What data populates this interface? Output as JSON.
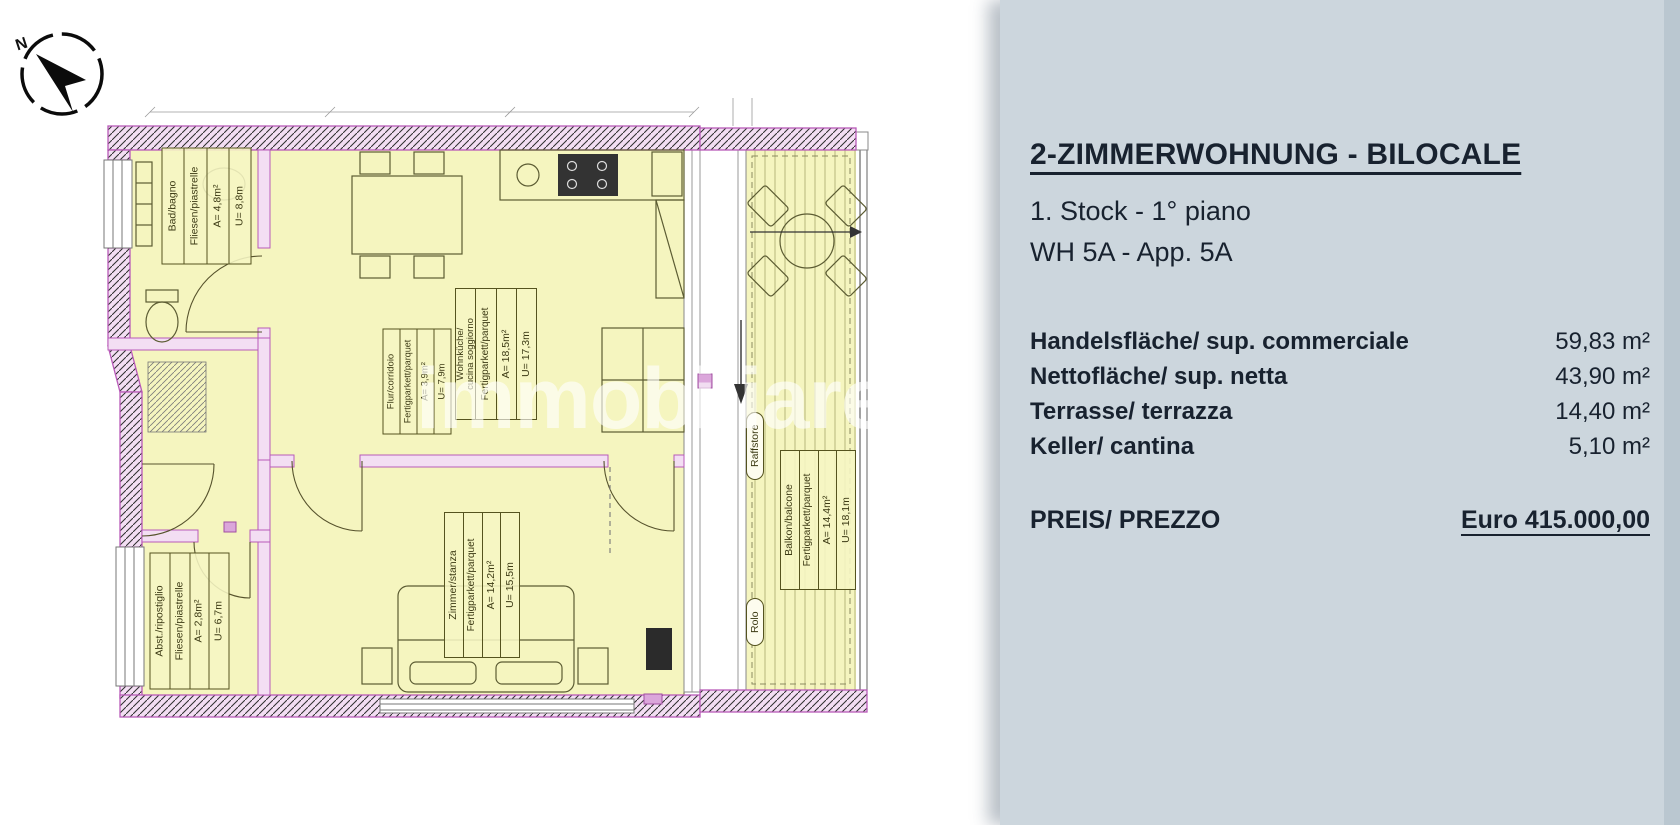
{
  "panel": {
    "title": "2-ZIMMERWOHNUNG - BILOCALE",
    "floor_line": "1. Stock - 1° piano",
    "unit_line": "WH 5A - App. 5A",
    "area_rows": [
      {
        "label": "Handelsfläche/ sup. commerciale",
        "value": "59,83 m²"
      },
      {
        "label": "Nettofläche/ sup. netta",
        "value": "43,90 m²"
      },
      {
        "label": "Terrasse/ terrazza",
        "value": "14,40 m²"
      },
      {
        "label": "Keller/ cantina",
        "value": "5,10 m²"
      }
    ],
    "price": {
      "label": "PREIS/ PREZZO",
      "value": "Euro 415.000,00"
    }
  },
  "plan": {
    "compass_label": "N",
    "watermark": "immobiliare.it",
    "rooms": [
      {
        "name": "Bad/bagno",
        "flooring": "Fliesen/piastrelle",
        "area": "A= 4,8m²",
        "perimeter": "U= 8,8m"
      },
      {
        "name": "Flur/corridoio",
        "flooring": "Fertigparkett/parquet",
        "area": "A= 3,9m²",
        "perimeter": "U= 7,9m"
      },
      {
        "name": "Wohnküche/",
        "name2": "cucina soggiorno",
        "flooring": "Fertigparkett/parquet",
        "area": "A= 18,5m²",
        "perimeter": "U= 17,3m"
      },
      {
        "name": "Zimmer/stanza",
        "flooring": "Fertigparkett/parquet",
        "area": "A= 14,2m²",
        "perimeter": "U= 15,5m"
      },
      {
        "name": "Abst./ripostiglio",
        "flooring": "Fliesen/piastrelle",
        "area": "A= 2,8m²",
        "perimeter": "U= 6,7m"
      },
      {
        "name": "Balkon/balcone",
        "flooring": "Fertigparkett/parquet",
        "area": "A= 14,4m²",
        "perimeter": "U= 18,1m"
      }
    ],
    "shade_labels": {
      "raffstore": "Raffstore",
      "rolo": "Rolo"
    }
  },
  "colors": {
    "panel_bg": "#ccd6dd",
    "panel_text": "#18222f",
    "room_fill": "#f5f5bf",
    "wall_fill": "#f3def3",
    "wall_edge": "#b85ab8"
  }
}
